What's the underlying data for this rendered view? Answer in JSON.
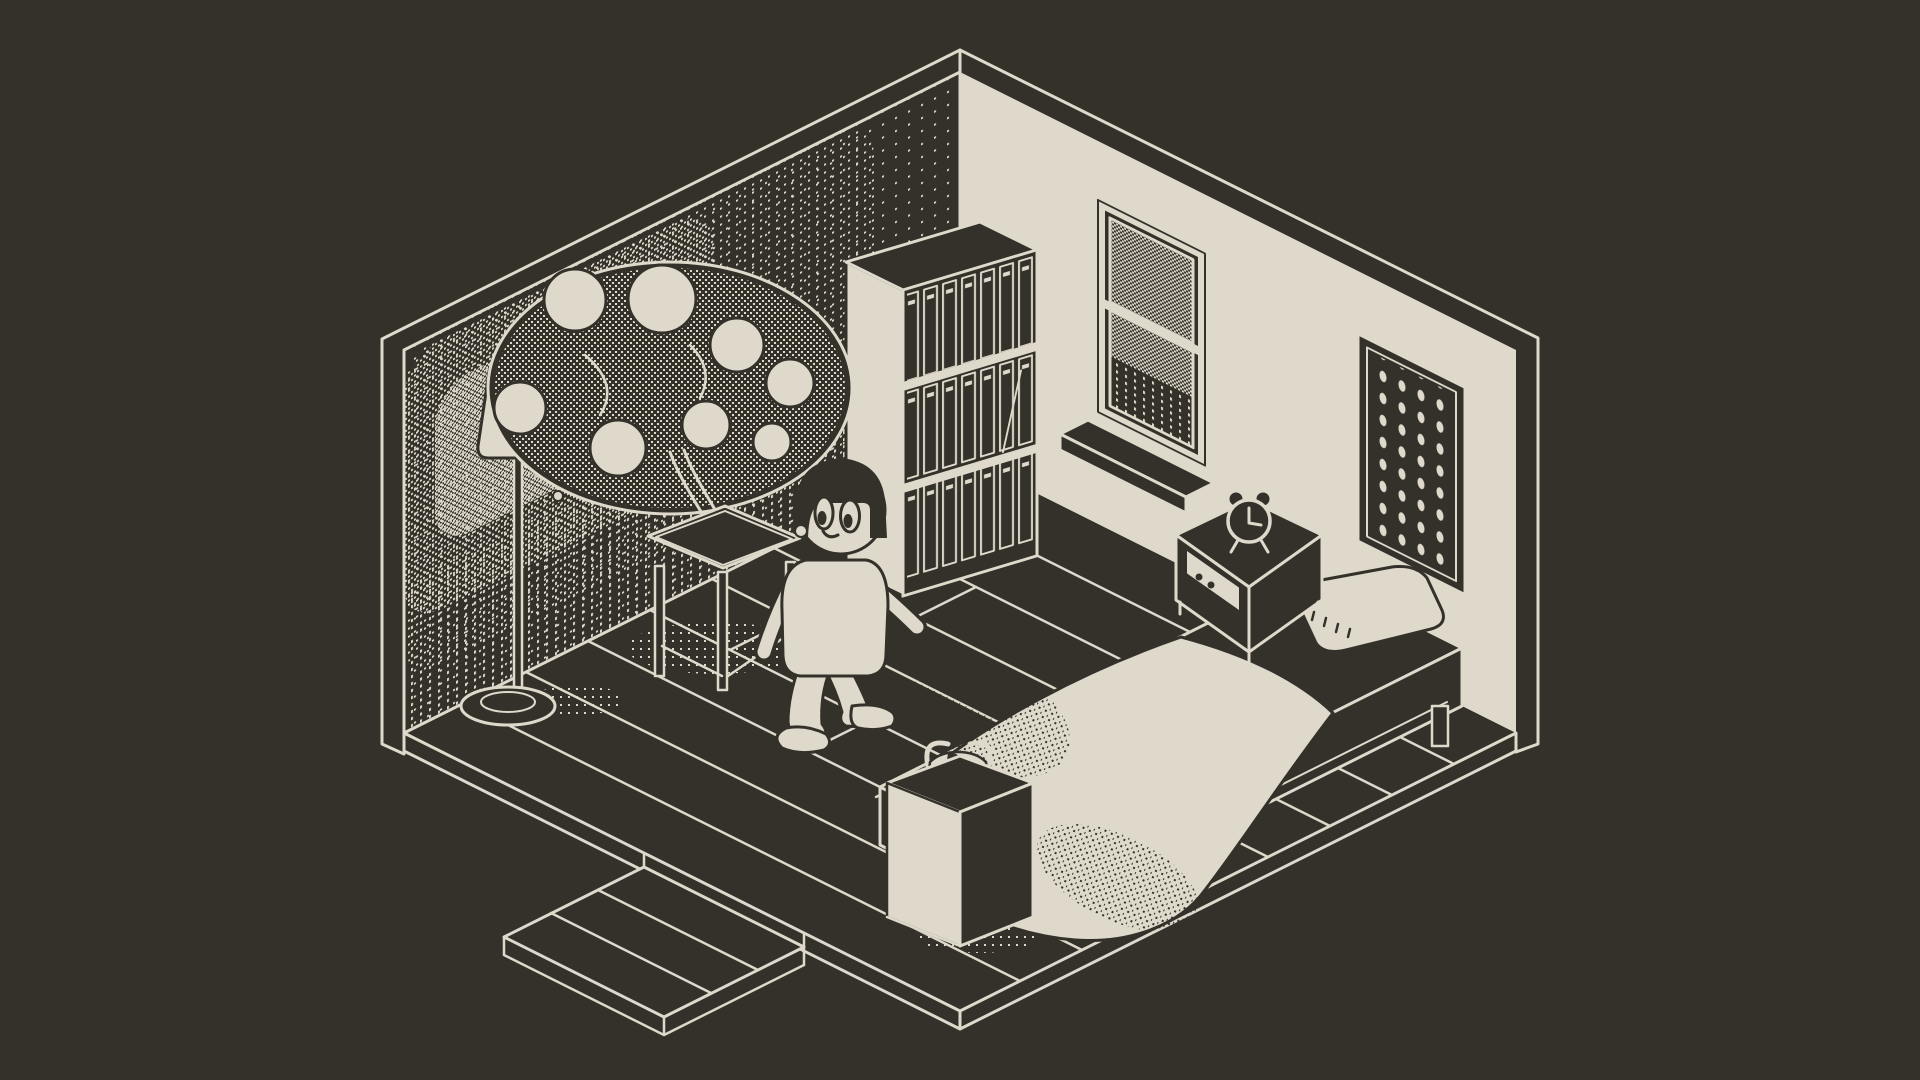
{
  "scene": {
    "title": "Isometric pixel-art bedroom at night",
    "style": "1-bit dithered pixel art, dark room lit by a floor lamp",
    "view": "isometric"
  },
  "palette": {
    "ink": "#34312b",
    "paper": "#ded9cb"
  },
  "objects": {
    "room": {
      "label": "isometric bedroom diorama"
    },
    "left_wall": {
      "label": "left wall with dithered lamp glow"
    },
    "right_wall": {
      "label": "right wall"
    },
    "floor": {
      "label": "wood plank floor"
    },
    "walkway": {
      "label": "plank walkway step at front-left"
    },
    "lamp": {
      "label": "floor lamp with pull chain"
    },
    "glow": {
      "label": "lamp light glow dither"
    },
    "plant": {
      "label": "round-leaf tree on side table"
    },
    "side_table": {
      "label": "wooden side table"
    },
    "bookshelf": {
      "label": "tall bookshelf full of books",
      "shelves": 3
    },
    "window": {
      "label": "sash window showing dithered night sky",
      "panes": 2
    },
    "windowsill": {
      "label": "window sill"
    },
    "wall_art": {
      "label": "framed dot-grid artwork"
    },
    "nightstand": {
      "label": "nightstand with drawer",
      "knobs": 2
    },
    "alarm_clock": {
      "label": "twin-bell alarm clock",
      "time": "3:00"
    },
    "bed": {
      "label": "bed with frame and legs"
    },
    "pillow": {
      "label": "pillow"
    },
    "blanket": {
      "label": "draped blanket with dither shading"
    },
    "character": {
      "label": "child in pajamas walking toward viewer"
    },
    "pedestal": {
      "label": "tall pedestal"
    },
    "pot": {
      "label": "small pot with sprout and handle"
    },
    "shadows": {
      "label": "dithered floor shadows"
    }
  }
}
